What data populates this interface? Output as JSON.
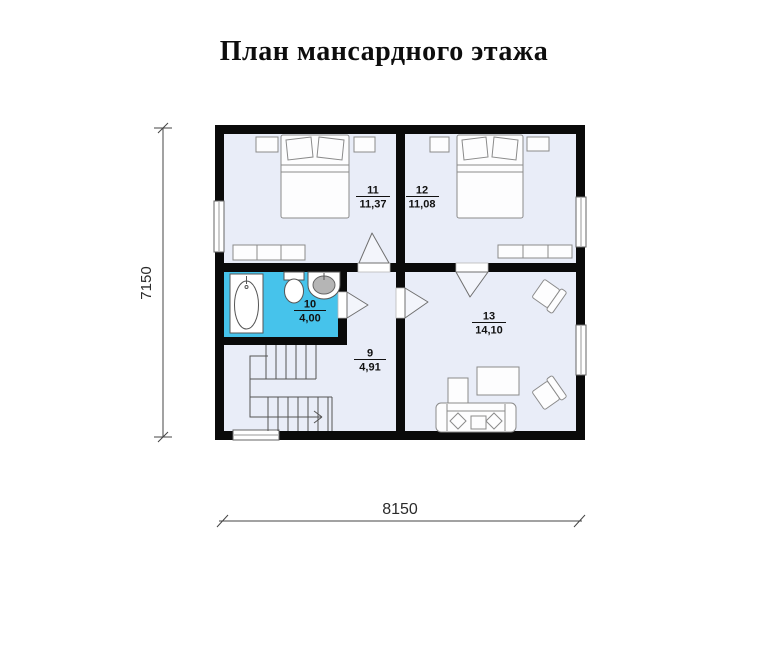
{
  "title": "План мансардного этажа",
  "dimensions": {
    "horizontal": "8150",
    "vertical": "7150"
  },
  "rooms": {
    "r9": {
      "number": "9",
      "area": "4,91"
    },
    "r10": {
      "number": "10",
      "area": "4,00"
    },
    "r11": {
      "number": "11",
      "area": "11,37"
    },
    "r12": {
      "number": "12",
      "area": "11,08"
    },
    "r13": {
      "number": "13",
      "area": "14,10"
    }
  },
  "colors": {
    "wall": "#0a0a0a",
    "floor": "#e9edf8",
    "bathroom_floor": "#46c3eb",
    "furniture_outline": "#8a8a8a"
  }
}
